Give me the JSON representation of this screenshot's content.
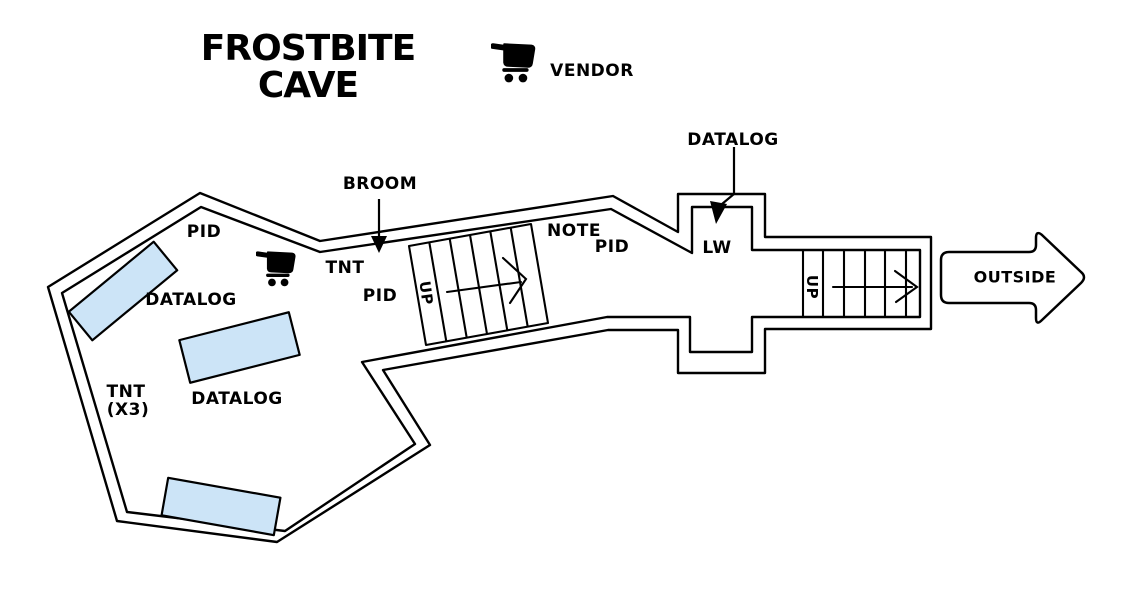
{
  "title": {
    "line1": "FROSTBITE",
    "line2": "CAVE"
  },
  "legend": {
    "icon": "shopping-cart-icon",
    "vendor_label": "VENDOR"
  },
  "colors": {
    "ink": "#000000",
    "platform_fill": "#cce4f7",
    "background": "#ffffff"
  },
  "labels": [
    {
      "id": "label-pid-upper",
      "text": "PID",
      "x": 204,
      "y": 232
    },
    {
      "id": "label-datalog-west",
      "text": "DATALOG",
      "x": 191,
      "y": 300
    },
    {
      "id": "label-tnt-center",
      "text": "TNT",
      "x": 345,
      "y": 268
    },
    {
      "id": "label-pid-center",
      "text": "PID",
      "x": 380,
      "y": 296
    },
    {
      "id": "label-broom",
      "text": "BROOM",
      "x": 380,
      "y": 184
    },
    {
      "id": "label-tnt-x3-line1",
      "text": "TNT",
      "x": 126,
      "y": 392
    },
    {
      "id": "label-tnt-x3-line2",
      "text": "(X3)",
      "x": 128,
      "y": 410
    },
    {
      "id": "label-datalog-south",
      "text": "DATALOG",
      "x": 237,
      "y": 399
    },
    {
      "id": "label-note",
      "text": "NOTE",
      "x": 574,
      "y": 231
    },
    {
      "id": "label-pid-east",
      "text": "PID",
      "x": 612,
      "y": 247
    },
    {
      "id": "label-datalog-north",
      "text": "DATALOG",
      "x": 733,
      "y": 140
    },
    {
      "id": "label-lw",
      "text": "LW",
      "x": 717,
      "y": 248
    },
    {
      "id": "label-up-lower-stairs",
      "text": "UP",
      "x": 426,
      "y": 293,
      "rotate": 82,
      "size": 15
    },
    {
      "id": "label-up-upper-stairs",
      "text": "UP",
      "x": 812,
      "y": 287,
      "rotate": 90,
      "size": 15
    },
    {
      "id": "label-outside",
      "text": "OUTSIDE",
      "x": 1015,
      "y": 277,
      "size": 16
    }
  ]
}
